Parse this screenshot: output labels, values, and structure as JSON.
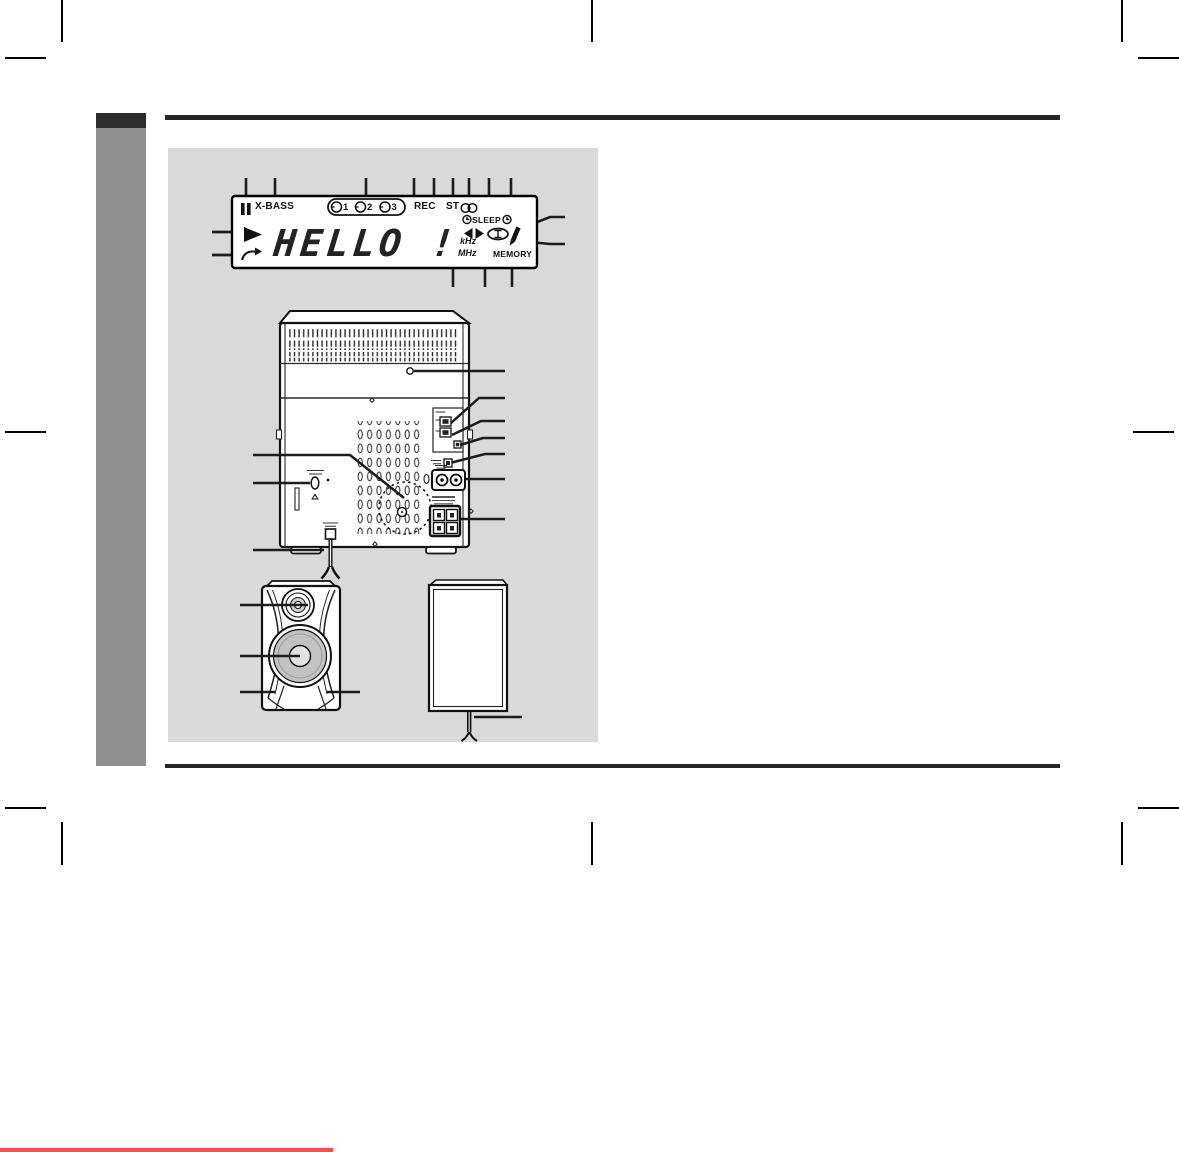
{
  "display": {
    "segment_text": "HELLO !",
    "indicators": {
      "x_bass": "X-BASS",
      "rec": "REC",
      "st": "ST",
      "sleep": "SLEEP",
      "khz": "kHz",
      "mhz": "MHz",
      "memory": "MEMORY"
    },
    "disc_numbers": [
      "1",
      "2",
      "3"
    ]
  },
  "icons": [
    "pause-icon",
    "play-icon",
    "repeat-icon",
    "disc-icon",
    "stereo-icon",
    "timer-clock-icon",
    "tuning-arrows-icon",
    "tuned-icon",
    "write-icon"
  ],
  "colors": {
    "panel_bg": "#d9d9d9",
    "sidebar_gray": "#8f8f8f",
    "sidebar_dark": "#2d2d2d",
    "rule": "#262626",
    "line_art": "#1b1b1b",
    "accent_red": "#ea5750"
  }
}
